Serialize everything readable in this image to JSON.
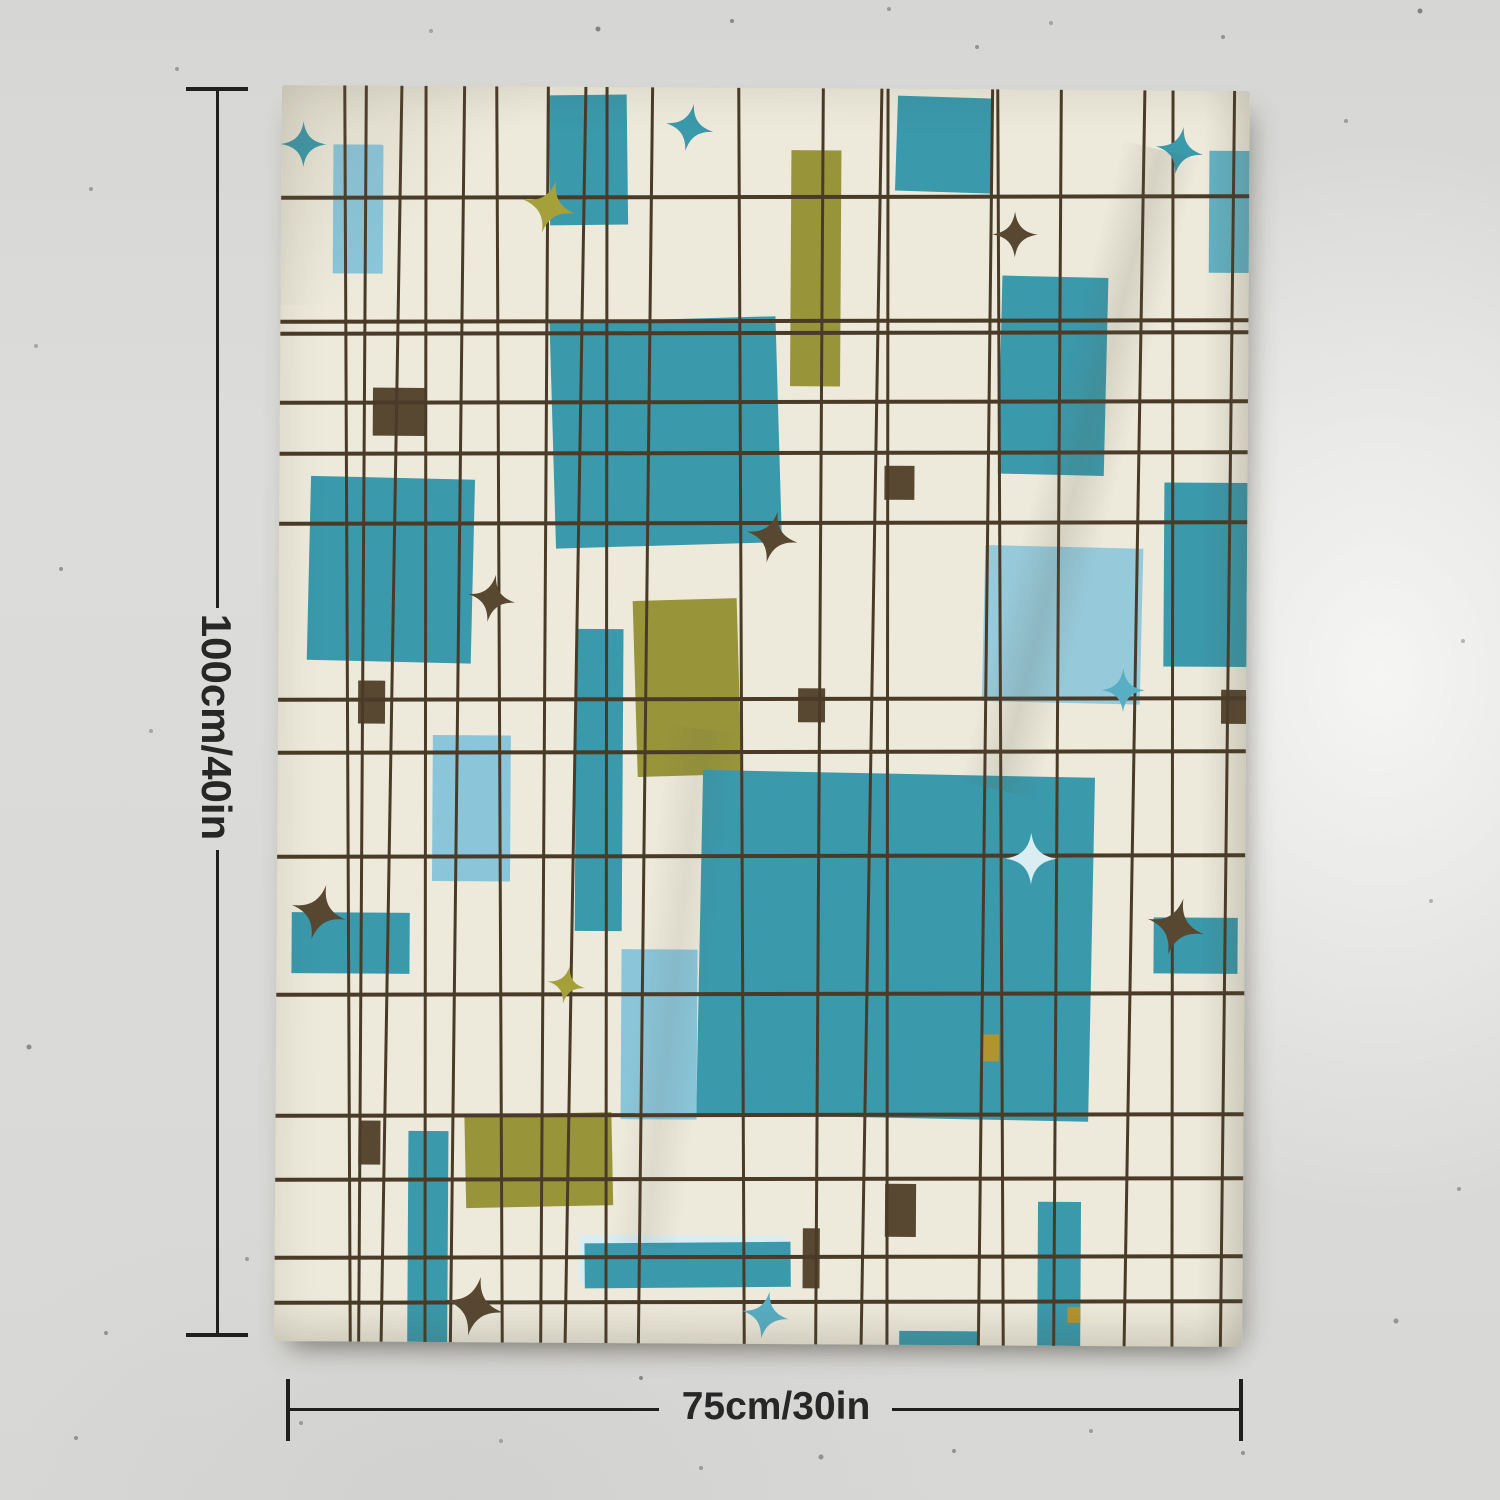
{
  "annotations": {
    "height_label": "100cm/40in",
    "width_label": "75cm/30in"
  },
  "palette": {
    "wall": "#d9d9d7",
    "fabric": "#edeadc",
    "line": "#4a3b28",
    "teal": "#3a99ab",
    "tealsoft": "#64b2c4",
    "lightblue": "#8ac5d9",
    "midblue": "#58afc3",
    "pale": "#d9edf3",
    "olive": "#97943a",
    "olivestar": "#a5a03a",
    "brown": "#584731",
    "mustard": "#b2932e",
    "dimension": "#1f1f1f"
  },
  "tapestry": {
    "grid": {
      "vertical_x": [
        68,
        83,
        112,
        146,
        178,
        220,
        265,
        296,
        327,
        366,
        462,
        540,
        592,
        608,
        706,
        721,
        778,
        855,
        893,
        948
      ],
      "horizontal_y": [
        107,
        231,
        243,
        312,
        363,
        433,
        609,
        662,
        766,
        904,
        1025,
        1089,
        1167,
        1212
      ]
    },
    "rects": [
      {
        "x": 52,
        "y": 59,
        "w": 50,
        "h": 129,
        "c": "lightblue"
      },
      {
        "x": 268,
        "y": 8,
        "w": 78,
        "h": 130,
        "c": "teal",
        "r": -1
      },
      {
        "x": 615,
        "y": 8,
        "w": 96,
        "h": 95,
        "c": "teal",
        "r": 1.5
      },
      {
        "x": 510,
        "y": 62,
        "w": 50,
        "h": 236,
        "c": "olive"
      },
      {
        "x": 928,
        "y": 60,
        "w": 45,
        "h": 122,
        "c": "tealsoft"
      },
      {
        "x": 720,
        "y": 187,
        "w": 106,
        "h": 198,
        "c": "teal",
        "r": 1
      },
      {
        "x": 273,
        "y": 232,
        "w": 226,
        "h": 226,
        "c": "teal",
        "r": -2
      },
      {
        "x": 30,
        "y": 392,
        "w": 164,
        "h": 184,
        "c": "teal",
        "r": 1
      },
      {
        "x": 155,
        "y": 649,
        "w": 78,
        "h": 146,
        "c": "lightblue"
      },
      {
        "x": 298,
        "y": 542,
        "w": 47,
        "h": 302,
        "c": "teal"
      },
      {
        "x": 357,
        "y": 512,
        "w": 104,
        "h": 176,
        "c": "olive",
        "r": -2
      },
      {
        "x": 885,
        "y": 392,
        "w": 86,
        "h": 184,
        "c": "teal"
      },
      {
        "x": 705,
        "y": 457,
        "w": 158,
        "h": 156,
        "c": "lightblue",
        "o": 0.88,
        "r": 1
      },
      {
        "x": 423,
        "y": 685,
        "w": 392,
        "h": 344,
        "c": "teal",
        "r": 0.8
      },
      {
        "x": 15,
        "y": 827,
        "w": 118,
        "h": 61,
        "c": "teal"
      },
      {
        "x": 345,
        "y": 862,
        "w": 76,
        "h": 170,
        "c": "lightblue"
      },
      {
        "x": 190,
        "y": 1027,
        "w": 147,
        "h": 93,
        "c": "olive",
        "r": -1.5
      },
      {
        "x": 133,
        "y": 1045,
        "w": 40,
        "h": 211,
        "c": "teal"
      },
      {
        "x": 877,
        "y": 827,
        "w": 84,
        "h": 56,
        "c": "teal"
      },
      {
        "x": 304,
        "y": 1148,
        "w": 208,
        "h": 48,
        "c": "pale"
      },
      {
        "x": 310,
        "y": 1155,
        "w": 206,
        "h": 45,
        "c": "teal",
        "r": -0.8
      },
      {
        "x": 763,
        "y": 1112,
        "w": 43,
        "h": 144,
        "c": "teal"
      },
      {
        "x": 625,
        "y": 1242,
        "w": 80,
        "h": 16,
        "c": "teal"
      },
      {
        "x": 707,
        "y": 945,
        "w": 16,
        "h": 27,
        "c": "mustard"
      },
      {
        "x": 793,
        "y": 1217,
        "w": 13,
        "h": 16,
        "c": "mustard"
      }
    ],
    "squares": [
      {
        "x": 93,
        "y": 302,
        "w": 53,
        "h": 48
      },
      {
        "x": 605,
        "y": 377,
        "w": 30,
        "h": 34
      },
      {
        "x": 520,
        "y": 600,
        "w": 27,
        "h": 34
      },
      {
        "x": 80,
        "y": 595,
        "w": 27,
        "h": 43
      },
      {
        "x": 943,
        "y": 599,
        "w": 25,
        "h": 34
      },
      {
        "x": 83,
        "y": 1035,
        "w": 22,
        "h": 44
      },
      {
        "x": 610,
        "y": 1095,
        "w": 31,
        "h": 53
      },
      {
        "x": 528,
        "y": 1140,
        "w": 17,
        "h": 60
      }
    ],
    "stars": [
      {
        "cx": 22,
        "cy": 59,
        "s": 46,
        "c": "teal"
      },
      {
        "cx": 408,
        "cy": 40,
        "s": 48,
        "c": "teal",
        "r": 10
      },
      {
        "cx": 268,
        "cy": 120,
        "s": 54,
        "c": "olivestar",
        "r": 15
      },
      {
        "cx": 898,
        "cy": 60,
        "s": 48,
        "c": "teal",
        "r": 10
      },
      {
        "cx": 734,
        "cy": 145,
        "s": 46,
        "c": "brown"
      },
      {
        "cx": 213,
        "cy": 512,
        "s": 48,
        "c": "brown",
        "r": 10
      },
      {
        "cx": 493,
        "cy": 449,
        "s": 52,
        "c": "brown",
        "r": 12
      },
      {
        "cx": 845,
        "cy": 600,
        "s": 44,
        "c": "midblue"
      },
      {
        "cx": 42,
        "cy": 827,
        "s": 56,
        "c": "brown",
        "r": 15
      },
      {
        "cx": 290,
        "cy": 898,
        "s": 38,
        "c": "olivestar",
        "r": 10
      },
      {
        "cx": 754,
        "cy": 769,
        "s": 52,
        "c": "pale"
      },
      {
        "cx": 899,
        "cy": 836,
        "s": 58,
        "c": "brown",
        "r": 15
      },
      {
        "cx": 200,
        "cy": 1220,
        "s": 60,
        "c": "brown",
        "r": 12
      },
      {
        "cx": 491,
        "cy": 1227,
        "s": 48,
        "c": "midblue",
        "r": 10
      }
    ]
  }
}
